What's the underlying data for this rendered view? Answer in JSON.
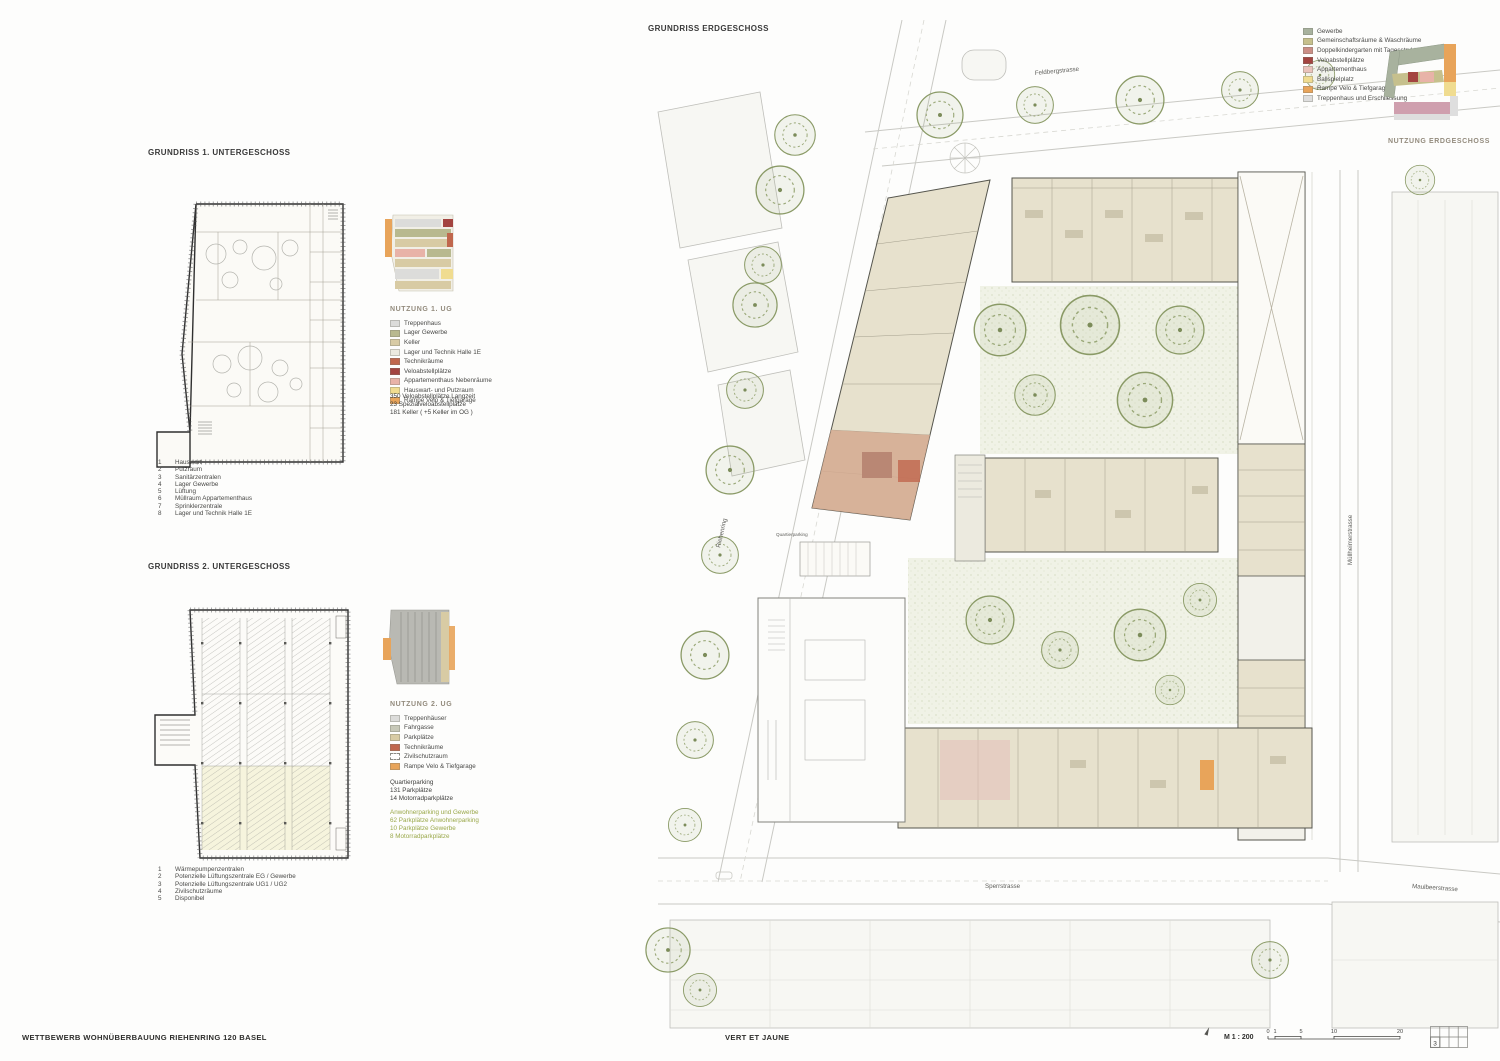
{
  "ug1": {
    "title": "GRUNDRISS 1. UNTERGESCHOSS",
    "legend_title": "NUTZUNG 1. UG",
    "legend": [
      {
        "label": "Treppenhaus",
        "color": "#dcdcda"
      },
      {
        "label": "Lager Gewerbe",
        "color": "#b8b98f"
      },
      {
        "label": "Keller",
        "color": "#d8cba4"
      },
      {
        "label": "Lager und Technik Halle 1E",
        "color": "#eceadf"
      },
      {
        "label": "Technikräume",
        "color": "#c0674d"
      },
      {
        "label": "Veloabstellplätze",
        "color": "#a34440"
      },
      {
        "label": "Appartementhaus Nebenräume",
        "color": "#e8b3a8"
      },
      {
        "label": "Hauswart- und Putzraum",
        "color": "#f0dc90"
      },
      {
        "label": "Rampe Velo & Tiefgarage",
        "color": "#e8a45a"
      }
    ],
    "stats": [
      "350 Veloabstellplätze Langzeit",
      "23 Spezialveloabstellplätze",
      "",
      "181 Keller ( +5 Keller im OG )"
    ],
    "key": [
      {
        "num": "1",
        "label": "Hauswart"
      },
      {
        "num": "2",
        "label": "Putzraum"
      },
      {
        "num": "3",
        "label": "Sanitärzentralen"
      },
      {
        "num": "4",
        "label": "Lager Gewerbe"
      },
      {
        "num": "5",
        "label": "Lüftung"
      },
      {
        "num": "6",
        "label": "Müllraum Appartementhaus"
      },
      {
        "num": "7",
        "label": "Sprinklerzentrale"
      },
      {
        "num": "8",
        "label": "Lager und Technik Halle 1E"
      }
    ]
  },
  "ug2": {
    "title": "GRUNDRISS 2. UNTERGESCHOSS",
    "legend_title": "NUTZUNG 2. UG",
    "legend": [
      {
        "label": "Treppenhäuser",
        "color": "#dcdcda"
      },
      {
        "label": "Fahrgasse",
        "color": "#c7c8b8"
      },
      {
        "label": "Parkplätze",
        "color": "#d8cba4"
      },
      {
        "label": "Technikräume",
        "color": "#c0674d"
      },
      {
        "label": "Zivilschutzraum",
        "color": "#ffffff",
        "dashed": true
      },
      {
        "label": "Rampe Velo & Tiefgarage",
        "color": "#e8a45a"
      }
    ],
    "stats_black": [
      "Quartierparking",
      "131 Parkplätze",
      "14 Motorradparkplätze"
    ],
    "stats_green": [
      "Anwohnerparking und Gewerbe",
      "62 Parkplätze Anwohnerparking",
      "10 Parkplätze Gewerbe",
      "8 Motorradparkplätze"
    ],
    "key": [
      {
        "num": "1",
        "label": "Wärmepumpenzentralen"
      },
      {
        "num": "2",
        "label": "Potenzielle Lüftungszentrale EG / Gewerbe"
      },
      {
        "num": "3",
        "label": "Potenzielle Lüftungszentrale UG1 / UG2"
      },
      {
        "num": "4",
        "label": "Zivilschutzräume"
      },
      {
        "num": "5",
        "label": "Disponibel"
      }
    ]
  },
  "eg": {
    "title": "GRUNDRISS ERDGESCHOSS",
    "legend_title": "NUTZUNG ERDGESCHOSS",
    "legend": [
      {
        "label": "Gewerbe",
        "color": "#a8b29e"
      },
      {
        "label": "Gemeinschaftsräume & Waschräume",
        "color": "#c6c08d"
      },
      {
        "label": "Doppelkindergarten mit Tagesstruktur",
        "color": "#cb8e86"
      },
      {
        "label": "Veloabstellplätze",
        "color": "#a34440"
      },
      {
        "label": "Appartementhaus",
        "color": "#eac3bb"
      },
      {
        "label": "Ballspielplatz",
        "color": "#f0dc90"
      },
      {
        "label": "Rampe Velo & Tiefgarage",
        "color": "#e8a45a"
      },
      {
        "label": "Treppenhaus und Erschliessung",
        "color": "#dedede"
      }
    ],
    "streets": {
      "north": "Feldbergstrasse",
      "west": "Riehenring",
      "east": "Müllheimerstrasse",
      "south": "Sperrstrasse",
      "southeast": "Maulbeerstrasse"
    },
    "labels": {
      "ramp": "Quartierparking"
    }
  },
  "footer": {
    "project_title": "WETTBEWERB WOHNÜBERBAUUNG RIEHENRING 120 BASEL",
    "motto": "VERT ET JAUNE",
    "scale_label": "M 1 : 200",
    "scale_ticks": [
      "0",
      "1",
      "5",
      "10",
      "20"
    ],
    "sheet_index": "3"
  }
}
